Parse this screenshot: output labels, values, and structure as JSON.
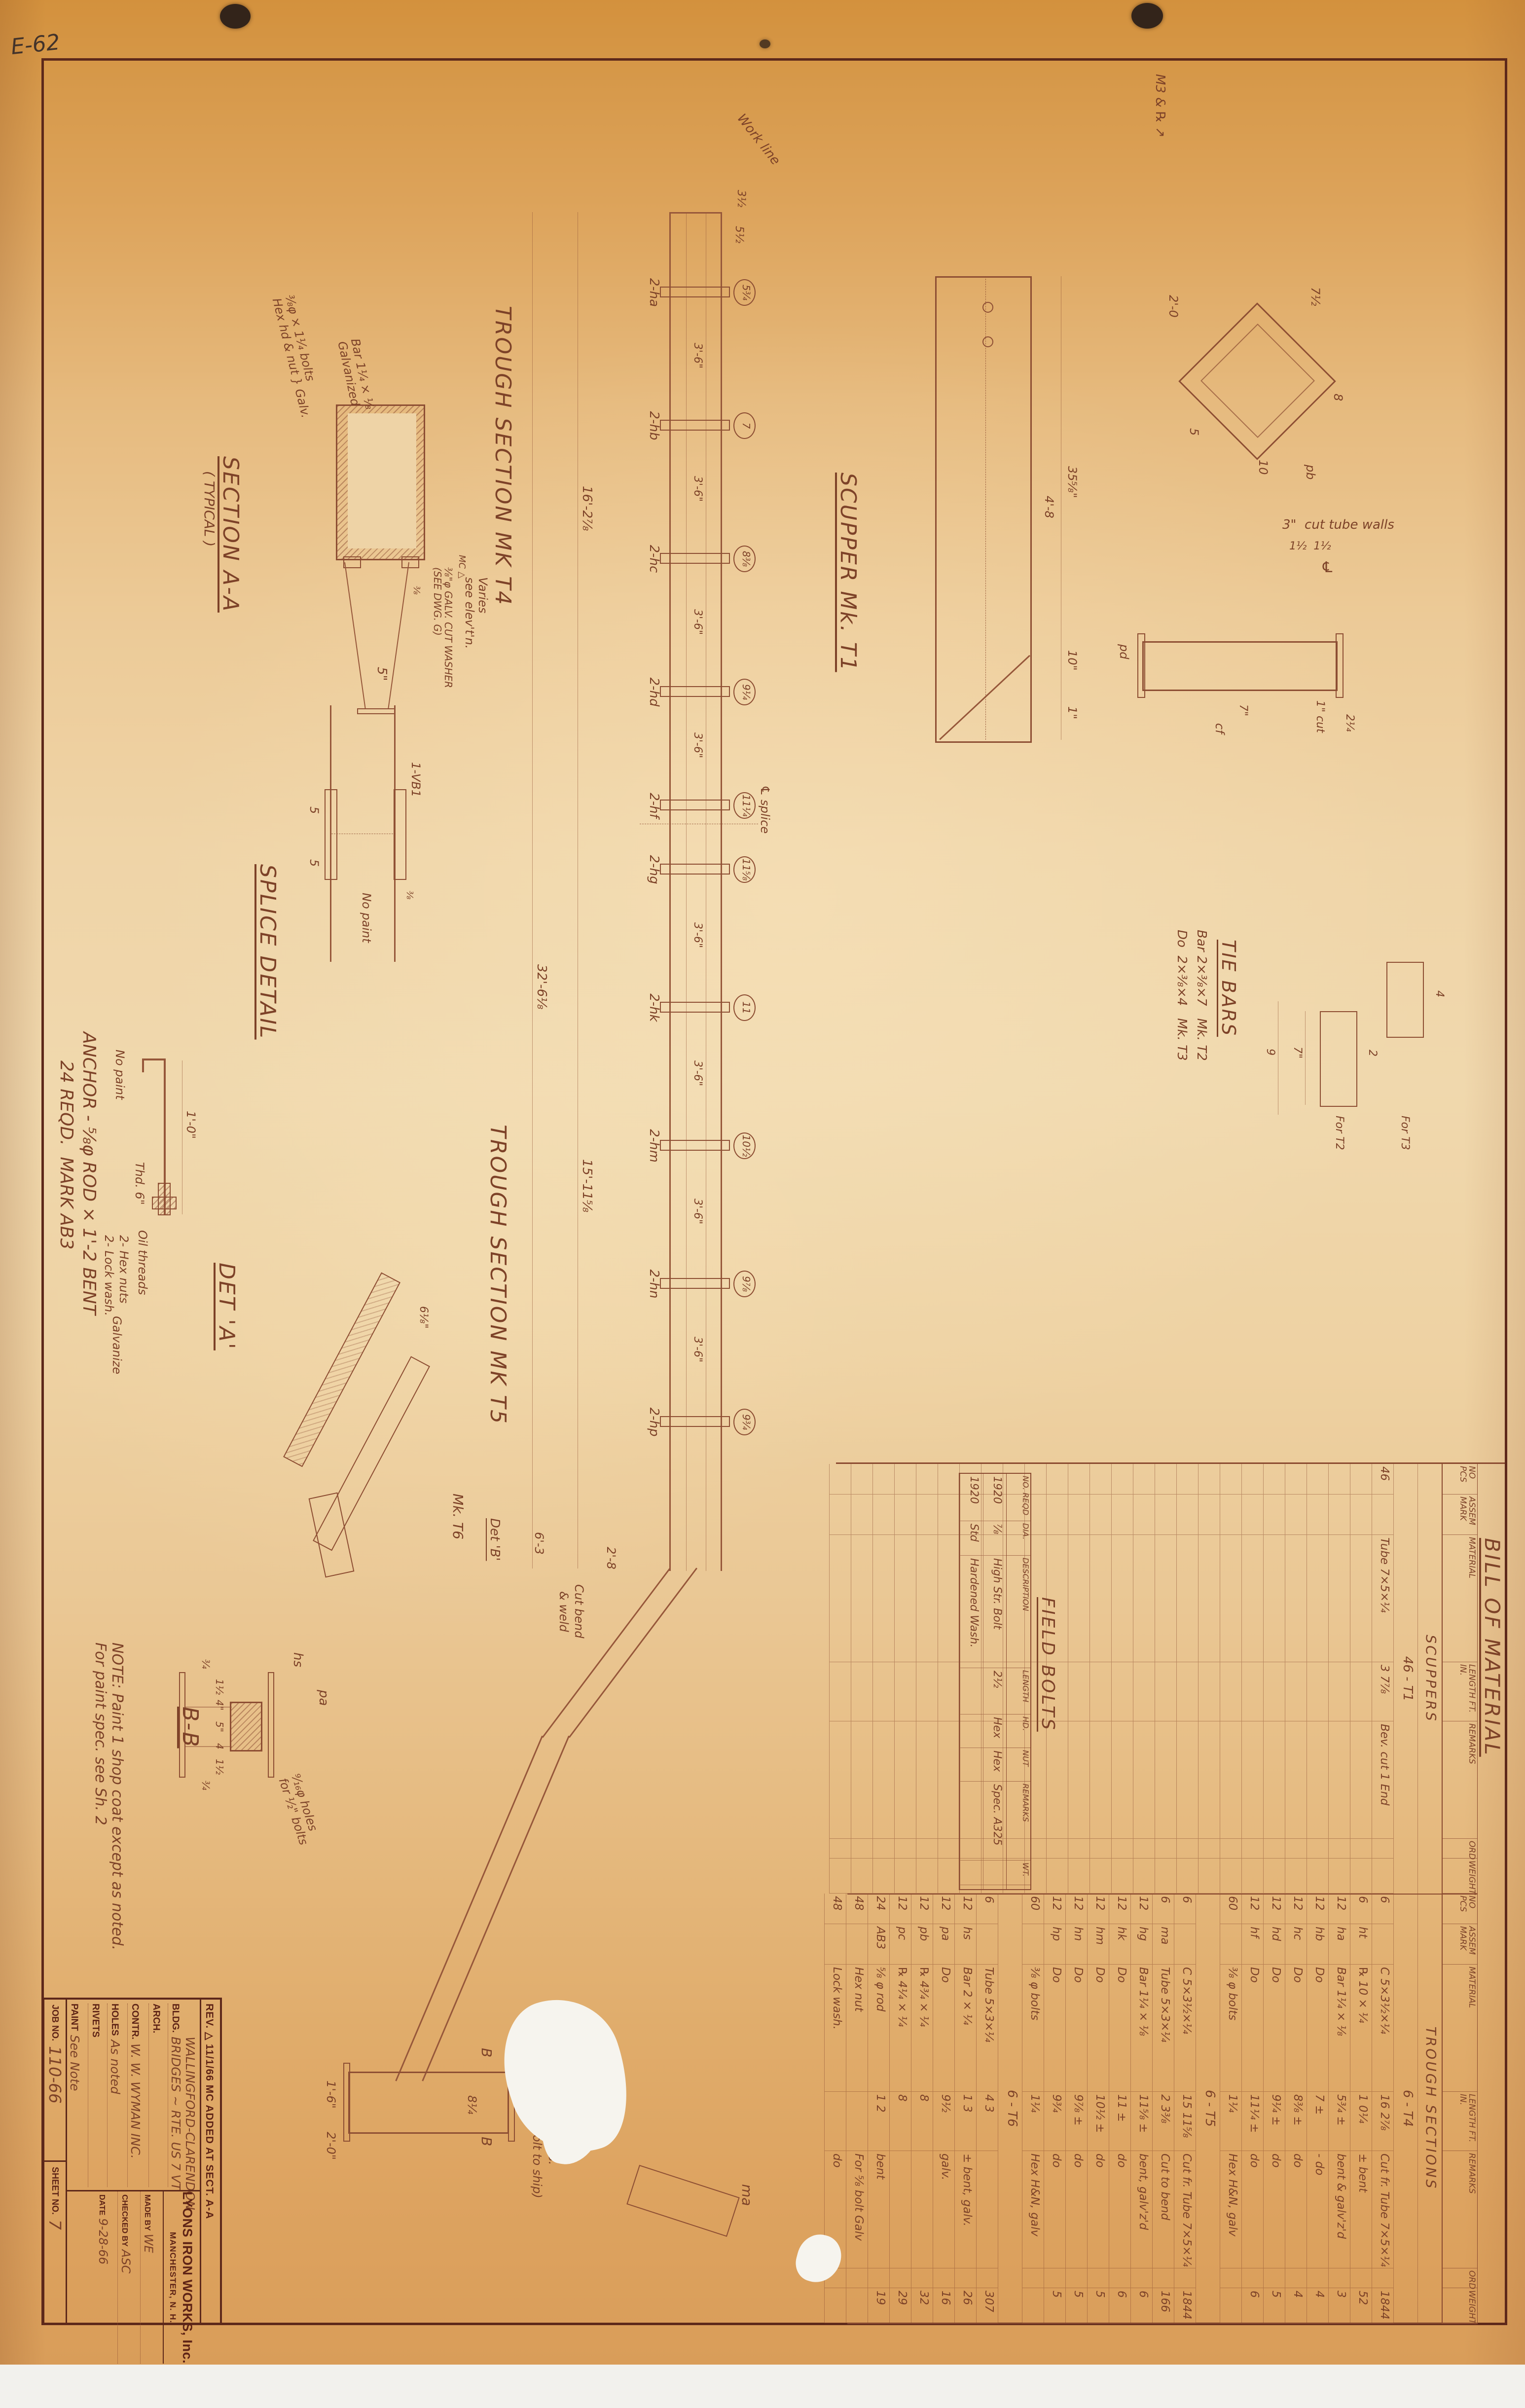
{
  "colors": {
    "paper_top": "#d79a4c",
    "paper_mid": "#f0d8ad",
    "paper_bottom": "#d99d59",
    "line": "#96573a",
    "ink": "#7d4228",
    "print": "#5e2315",
    "border": "#5d281a"
  },
  "page": {
    "stamp": "E-62"
  },
  "title_block": {
    "rev_line": "REV. △  11/1/66   MC   ADDED AT SECT. A-A",
    "company": "LYONS IRON WORKS, Inc.",
    "city": "MANCHESTER, N. H.",
    "bldg_label": "BLDG.",
    "bldg_value1": "WALLINGFORD-CLARENDON",
    "bldg_value2": "BRIDGES ~ RTE. US 7 VT",
    "arch_label": "ARCH.",
    "arch_value": "",
    "contr_label": "CONTR.",
    "contr_value": "W. W. WYMAN INC.",
    "holes_label": "HOLES",
    "holes_value": "As noted",
    "rivets_label": "RIVETS",
    "rivets_value": "",
    "paint_label": "PAINT",
    "paint_value": "See Note",
    "made_label": "MADE BY",
    "made_value": "WE",
    "checked_label": "CHECKED BY",
    "checked_value": "ASC",
    "date_label": "DATE",
    "date_value": "9-28-66",
    "job_label": "JOB NO.",
    "job_value": "110-66",
    "sheet_label": "SHEET NO.",
    "sheet_value": "7"
  },
  "bom": {
    "title": "BILL OF MATERIAL",
    "columns": [
      "NO\nPCS",
      "ASSEM\nMARK",
      "MATERIAL",
      "LENGTH\nFT. IN.",
      "REMARKS",
      "ORD",
      "WEIGHT"
    ],
    "left_rows": [
      {
        "s": "SCUPPERS"
      },
      {
        "g": "46 - T1"
      },
      {
        "c": [
          "46",
          "",
          "Tube 7×5×¼",
          "3 7⅞",
          "Bev. cut 1 End",
          "",
          ""
        ]
      }
    ],
    "right_rows": [
      {
        "s": "TROUGH SECTIONS"
      },
      {
        "g": "6 - T4"
      },
      {
        "c": [
          "6",
          "",
          "C 5×3½×¼",
          "16 2⅞",
          "Cut fr. Tube 7×5×¼  32'-6",
          "",
          "1844"
        ]
      },
      {
        "c": [
          "6",
          "ht",
          "℞ 10 × ¼",
          "1 0¼",
          "± bent",
          "",
          "52"
        ]
      },
      {
        "c": [
          "12",
          "ha",
          "Bar 1¼ × ⅛",
          "5¾ ±",
          "bent & galv'z'd",
          "",
          "3"
        ]
      },
      {
        "c": [
          "12",
          "hb",
          "Do",
          "7 ±",
          "- do",
          "",
          "4"
        ]
      },
      {
        "c": [
          "12",
          "hc",
          "Do",
          "8⅜ ±",
          "do",
          "",
          "4"
        ]
      },
      {
        "c": [
          "12",
          "hd",
          "Do",
          "9¼ ±",
          "do",
          "",
          "5"
        ]
      },
      {
        "c": [
          "12",
          "hf",
          "Do",
          "11¼ ±",
          "do",
          "",
          "6"
        ]
      },
      {
        "c": [
          "60",
          "",
          "⅜ φ bolts",
          "1¼",
          "Hex H&N, galv",
          "",
          ""
        ]
      },
      {
        "g": "6 - T5"
      },
      {
        "c": [
          "6",
          "",
          "C 5×3½×¼",
          "15 11⅝",
          "Cut fr. Tube 7×5×¼  32'-6",
          "",
          "1844"
        ]
      },
      {
        "c": [
          "6",
          "ma",
          "Tube 5×3×¼",
          "2 3⅜",
          "Cut to bend",
          "",
          "166"
        ]
      },
      {
        "c": [
          "12",
          "hg",
          "Bar 1¼ × ⅛",
          "11⅝ ±",
          "bent, galv'z'd",
          "",
          "6"
        ]
      },
      {
        "c": [
          "12",
          "hk",
          "Do",
          "11 ±",
          "do",
          "",
          "6"
        ]
      },
      {
        "c": [
          "12",
          "hm",
          "Do",
          "10½ ±",
          "do",
          "",
          "5"
        ]
      },
      {
        "c": [
          "12",
          "hn",
          "Do",
          "9⅞ ±",
          "do",
          "",
          "5"
        ]
      },
      {
        "c": [
          "12",
          "hp",
          "Do",
          "9¾",
          "do",
          "",
          "5"
        ]
      },
      {
        "c": [
          "60",
          "",
          "⅜ φ bolts",
          "1¼",
          "Hex H&N, galv",
          "",
          ""
        ]
      },
      {
        "g": "6 - T6"
      },
      {
        "c": [
          "6",
          "",
          "Tube 5×3×¼",
          "4 3",
          "",
          "",
          "307"
        ]
      },
      {
        "c": [
          "12",
          "hs",
          "Bar 2 × ¼",
          "1 3",
          "± bent, galv.",
          "",
          "26"
        ]
      },
      {
        "c": [
          "12",
          "pa",
          "Do",
          "9½",
          "galv.",
          "",
          "16"
        ]
      },
      {
        "c": [
          "12",
          "pb",
          "℞ 4¾ × ¼",
          "8",
          "",
          "",
          "32"
        ]
      },
      {
        "c": [
          "12",
          "pc",
          "℞ 4¼ × ¼",
          "8",
          "",
          "",
          "29"
        ]
      },
      {
        "c": [
          "24",
          "AB3",
          "⅝ φ rod",
          "1 2",
          "bent",
          "",
          "19"
        ]
      },
      {
        "c": [
          "48",
          "",
          "Hex nut",
          "",
          "For ⅝ bolt Galv",
          "",
          ""
        ]
      },
      {
        "c": [
          "48",
          "",
          "Lock wash.",
          "",
          "do",
          "",
          ""
        ]
      }
    ]
  },
  "field_bolts": {
    "title": "FIELD BOLTS",
    "columns": [
      "NO.\nREQD",
      "DIA.",
      "DESCRIPTION",
      "LENGTH",
      "HD.",
      "NUT",
      "REMARKS",
      "WT."
    ],
    "rows": [
      [
        "1920",
        "⅞",
        "High Str. Bolt",
        "2½",
        "Hex",
        "Hex",
        "Spec. A325",
        ""
      ],
      [
        "1920",
        "Std",
        "Hardened Wash.",
        "",
        "",
        "",
        "",
        ""
      ]
    ]
  },
  "girder": {
    "tie_marks": [
      "2-ha",
      "2-hb",
      "2-hc",
      "2-hd",
      "2-hf",
      "2-hg",
      "2-hk",
      "2-hm",
      "2-hn",
      "2-hp"
    ],
    "tie_values": [
      "5¾",
      "7",
      "8⅜",
      "9¼",
      "11¼",
      "11⅝",
      "11",
      "10½",
      "9⅞",
      "9¾"
    ],
    "spacing": "3'-6\""
  },
  "labels": {
    "trough_t4": "TROUGH SECTION MK T4",
    "trough_t5": "TROUGH SECTION MK T5",
    "scupper": "SCUPPER Mk. T1",
    "section_aa": "SECTION A-A",
    "section_aa2": "( TYPICAL )",
    "splice": "SPLICE DETAIL",
    "det_a": "DET 'A'",
    "det_b": "Det 'B'",
    "mk_t6": "Mk. T6",
    "bb": "B-B",
    "tie_bars": "TIE BARS",
    "tie_l1": "Bar 2×⅜×7   Mk. T2",
    "tie_l2": "Do  2×⅜×4   Mk. T3",
    "for_t2": "For T2",
    "for_t3": "For T3",
    "anchor1": "ANCHOR - ⅝φ ROD × 1'-2 BENT",
    "anchor2": "24 REQD.  MARK AB3",
    "thd6": "Thd. 6\"",
    "dim_1_0": "1'-0\"",
    "no_paint_a": "No paint",
    "no_paint_s": "No paint",
    "oil": "Oil threads",
    "hex1": "2- Hex nuts",
    "hex2": "2- Lock wash.",
    "hex3": "Galvanize",
    "note1": "NOTE: Paint 1 shop coat except as noted.",
    "note2": "For paint spec. see Sh. 2",
    "holes1": "⁹⁄₁₆φ holes",
    "holes2": "for ½\" bolts",
    "bolts1": "⅜φ × 1¼ bolts",
    "bolts2": "Hex hd & nut",
    "bolts3": "Galv.",
    "bar1": "Bar 1¼ × ⅛",
    "bar2": "Galvanized",
    "wash1": "⅜\"φ GALV. CUT WASHER",
    "wash2": "(SEE DWG. G)",
    "mc": "MC △",
    "varies1": "Varies",
    "varies2": "see elev't'n.",
    "work_line": "Work line",
    "cl_splice": "℄ splice",
    "vb1": "1-VB1",
    "dim5": "5\"",
    "sp5a": "5",
    "sp5b": "5",
    "weld38a": "⅜",
    "weld38b": "⅜",
    "cut_note": "3\"  cut tube walls",
    "cut_dims": "1½  1½",
    "cl": "℄",
    "m3pl": "M3 & ℞ ↗",
    "dim35": "35⅝\"",
    "dim10": "10\"",
    "dim1": "1\"",
    "dim48": "4'-8",
    "cut1": "1\" cut",
    "dim7s": "7\"",
    "dim2q": "2¼",
    "pd": "pd",
    "cf": "cf",
    "pb2": "pb",
    "hs": "hs",
    "pa": "pa",
    "ma": "ma",
    "ship1": "& h.s.",
    "ship2": "(Bolt to ship)",
    "dim16": "16'-2⅞",
    "dim15": "15'-11⅝",
    "dim32": "32'-6⅛",
    "dim55": "5½",
    "dim35b": "3½",
    "cutbend1": "Cut bend",
    "cutbend2": "& weld",
    "dim63": "6'-3",
    "dim28": "2'-8",
    "dim86": "8¼",
    "dim_1_6": "1'-6\"",
    "dim_2_0": "2'-0\"",
    "bcut1": "B",
    "bcut2": "B",
    "t2_d2": "2",
    "t2_d7": "7\"",
    "t2_d9": "9",
    "t3_d4": "4",
    "bd1": "1½",
    "bd2": "4\"",
    "bd3": "5\"",
    "bd4": "4",
    "bd5": "1½",
    "bd34a": "¾",
    "bd34b": "¾",
    "s45_0": "2'-0",
    "s45_1": "7½",
    "s45_2": "8",
    "s45_3": "10",
    "s45_4": "5",
    "deta_d1": "6⅛\""
  }
}
